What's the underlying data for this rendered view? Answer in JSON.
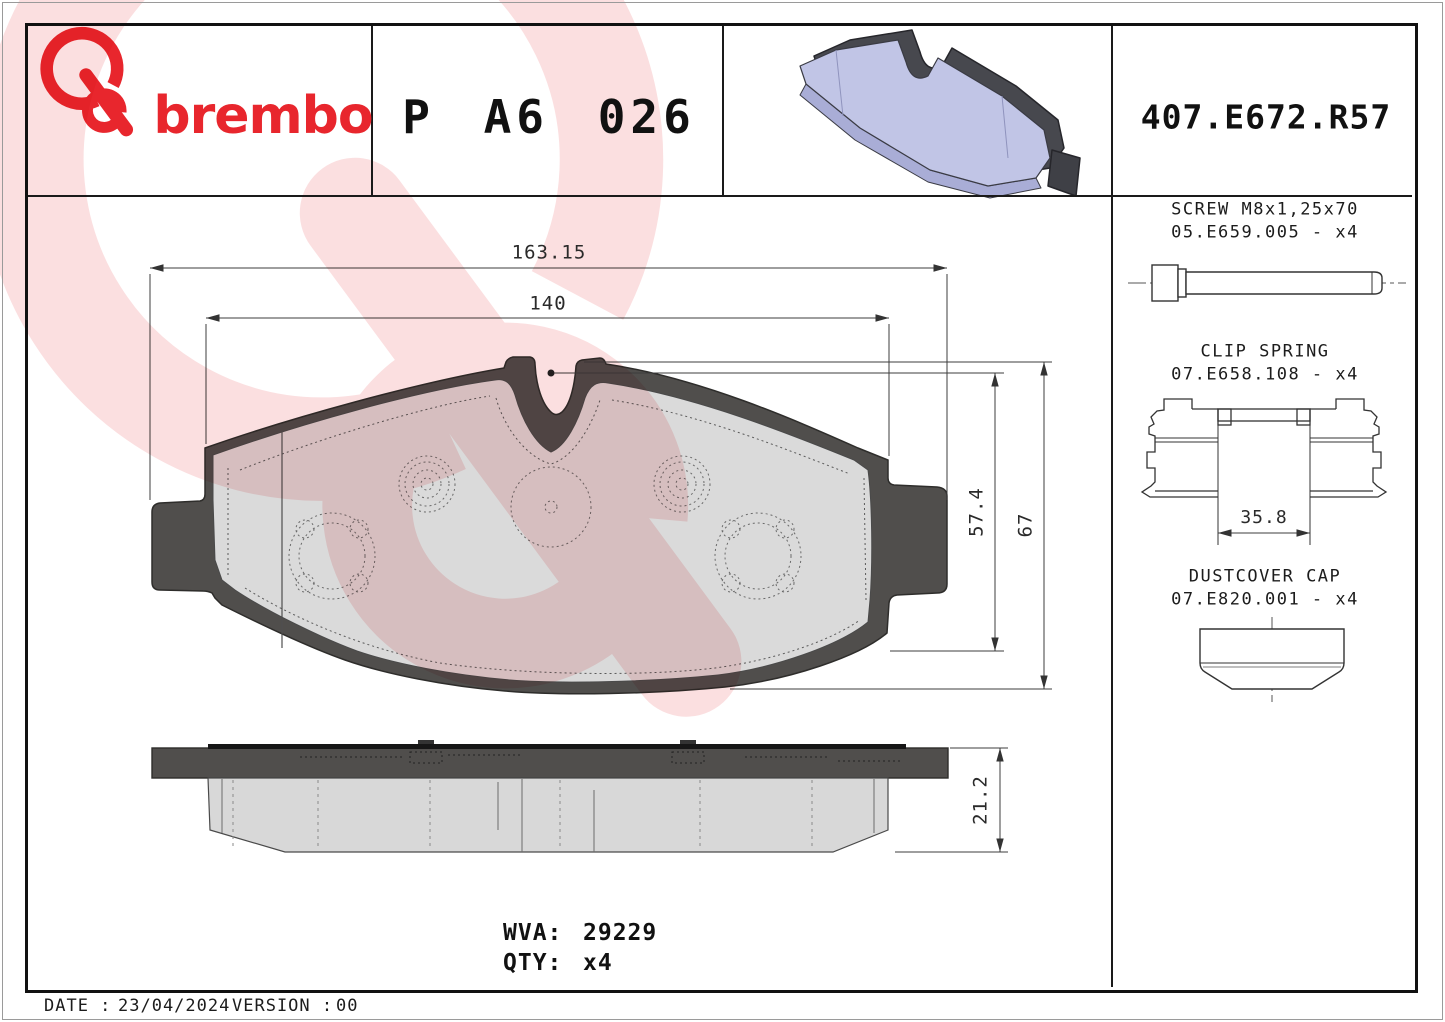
{
  "header": {
    "brand_name": "brembo",
    "part_number": "P A6 026",
    "reference": "407.E672.R57"
  },
  "front_view": {
    "dim_overall_width": "163.15",
    "dim_plate_width": "140",
    "dim_pad_height": "57.4",
    "dim_total_height": "67"
  },
  "side_view": {
    "dim_thickness": "21.2"
  },
  "hardware": [
    {
      "name": "SCREW M8x1,25x70",
      "code": "05.E659.005 - x4"
    },
    {
      "name": "CLIP SPRING",
      "code": "07.E658.108 - x4",
      "dim": "35.8"
    },
    {
      "name": "DUSTCOVER CAP",
      "code": "07.E820.001 - x4"
    }
  ],
  "summary": {
    "wva_label": "WVA:",
    "wva_value": "29229",
    "qty_label": "QTY:",
    "qty_value": "x4"
  },
  "footer": {
    "date_label": "DATE :",
    "date_value": "23/04/2024",
    "version_label": "VERSION :",
    "version_value": "00"
  },
  "colors": {
    "brand_red": "#e8262d",
    "watermark_red": "#e11b22",
    "plate_dark_gray": "#504e4c",
    "friction_gray": "#dadada",
    "photo_pad_lavender": "#c1c5e6",
    "photo_plate_dark": "#47484e",
    "drawing_line": "#3c3c3c"
  }
}
